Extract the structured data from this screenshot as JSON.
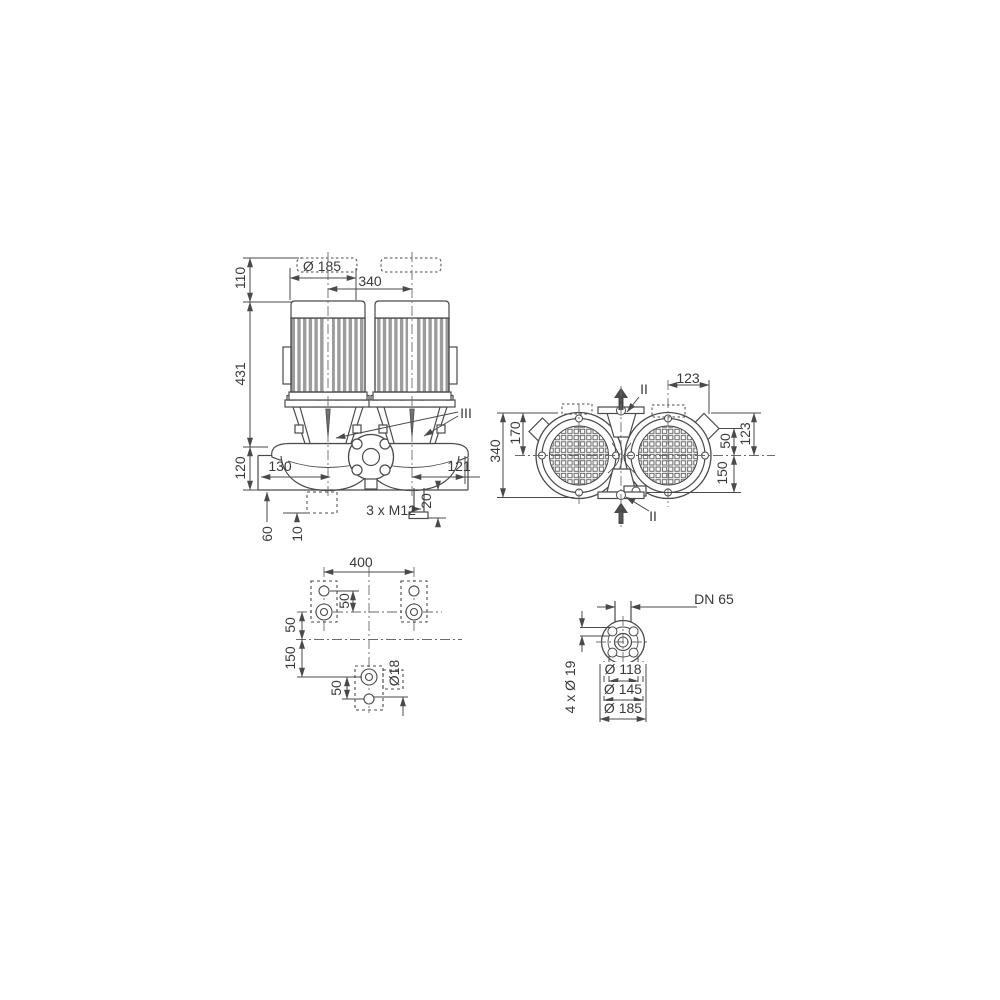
{
  "drawing": {
    "colors": {
      "line": "#4a4a4a",
      "fins": "#9c9c9c",
      "text": "#3a3a3a",
      "background": "#ffffff"
    },
    "front_view": {
      "dims": {
        "height_top": "110",
        "height_motor": "431",
        "height_base": "120",
        "motor_diameter": "Ø 185",
        "center_distance": "340",
        "left_offset": "130",
        "right_offset": "121",
        "foundation_depth": "60",
        "pad_thickness": "10",
        "stub_length": "20",
        "anchor_bolts": "3 x M12"
      },
      "section_label": "III"
    },
    "top_view": {
      "dims": {
        "total_depth": "340",
        "center_depth": "170",
        "flange_offset_top": "123",
        "port_offset": "50",
        "flange_offset_side": "123",
        "lower_offset": "150"
      },
      "section_label_top": "II",
      "section_label_bottom": "II"
    },
    "plan_view": {
      "dims": {
        "bolt_spacing": "400",
        "hole_offset_upper": "50",
        "axis_offset": "50",
        "lower_axis_offset": "150",
        "hole_offset_lower": "50",
        "hole_diameter": "Ø18"
      }
    },
    "flange_view": {
      "dims": {
        "nominal_diameter": "DN 65",
        "bolt_holes": "4 x Ø 19",
        "bolt_circle": "Ø 118",
        "raised_face": "Ø 145",
        "outer_diameter": "Ø 185"
      }
    }
  }
}
